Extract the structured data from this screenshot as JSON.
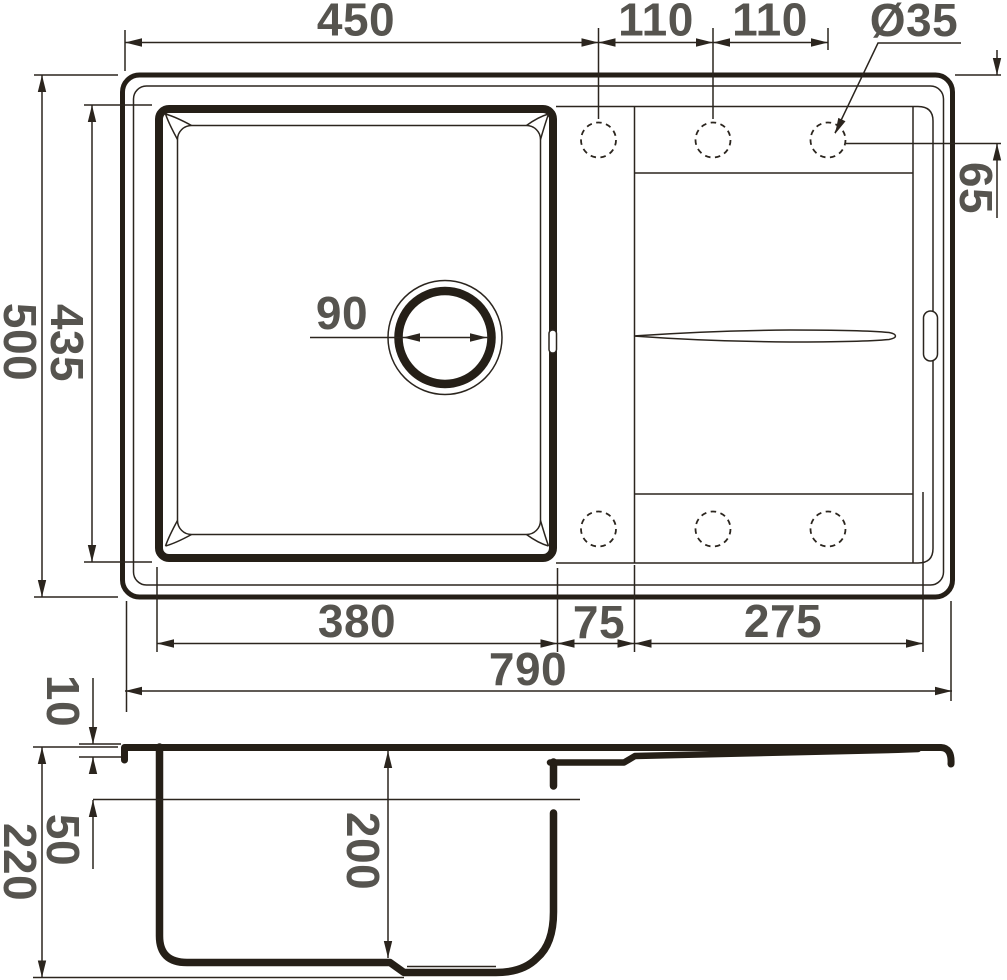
{
  "drawing": {
    "type": "sink-technical-drawing",
    "colors": {
      "line": "#251f17",
      "thin_line": "#2b251e",
      "label": "#56544f",
      "background": "#ffffff"
    }
  },
  "dims": {
    "w450": "450",
    "p110a": "110",
    "p110b": "110",
    "dia35": "Ø35",
    "h500": "500",
    "h435": "435",
    "d90": "90",
    "o65": "65",
    "w380": "380",
    "w75": "75",
    "w275": "275",
    "w790": "790",
    "t10": "10",
    "o50": "50",
    "h220": "220",
    "h200": "200"
  }
}
